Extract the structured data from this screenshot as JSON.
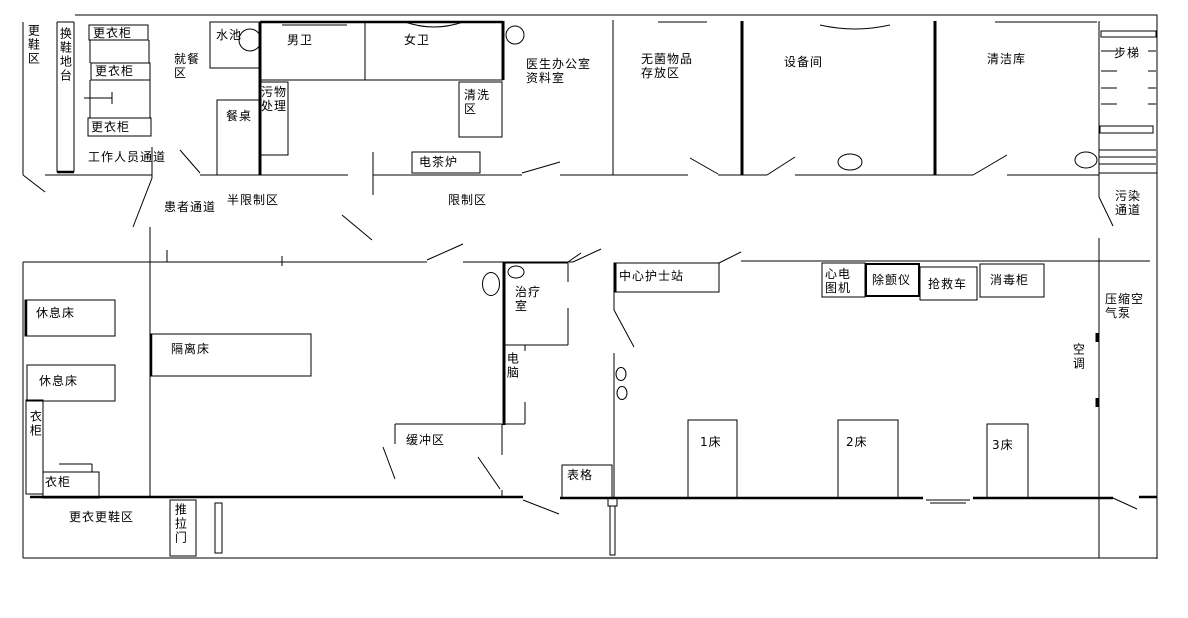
{
  "plan": {
    "top": {
      "shoe_change_area": "更鞋区",
      "shoe_change_platform": "换鞋地台",
      "locker_1": "更衣柜",
      "locker_2": "更衣柜",
      "locker_3": "更衣柜",
      "dining_area": "就餐\n区",
      "sink": "水池",
      "dining_table": "餐桌",
      "waste_disposal": "污物\n处理",
      "mens_toilet": "男卫",
      "womens_toilet": "女卫",
      "washing_area": "清洗\n区",
      "tea_boiler": "电茶炉",
      "doctor_office": "医生办公室\n资料室",
      "sterile_storage": "无菌物品\n存放区",
      "equipment_room": "设备间",
      "clean_storage": "清洁库",
      "staircase": "步梯"
    },
    "passages": {
      "staff": "工作人员通道",
      "patient": "患者通道",
      "semi_restricted": "半限制区",
      "restricted": "限制区",
      "contaminated": "污染\n通道"
    },
    "ward": {
      "rest_bed_1": "休息床",
      "rest_bed_2": "休息床",
      "isolation_bed": "隔离床",
      "wardrobe_tall": "衣柜",
      "wardrobe_low": "衣柜",
      "treatment_room": "治疗\n室",
      "computer": "电脑",
      "nurse_station": "中心护士站",
      "ecg_machine": "心电\n图机",
      "defibrillator": "除颤仪",
      "crash_cart": "抢救车",
      "disinfection_cabinet": "消毒柜",
      "air_conditioner": "空调",
      "compressed_air_pump": "压缩空\n气泵",
      "buffer_area": "缓冲区",
      "forms": "表格",
      "bed_1": "1床",
      "bed_2": "2床",
      "bed_3": "3床"
    },
    "bottom": {
      "change_clothes_shoes_area": "更衣更鞋区",
      "sliding_door": "推拉门"
    },
    "colors": {
      "line": "#000000",
      "background": "#ffffff"
    }
  }
}
